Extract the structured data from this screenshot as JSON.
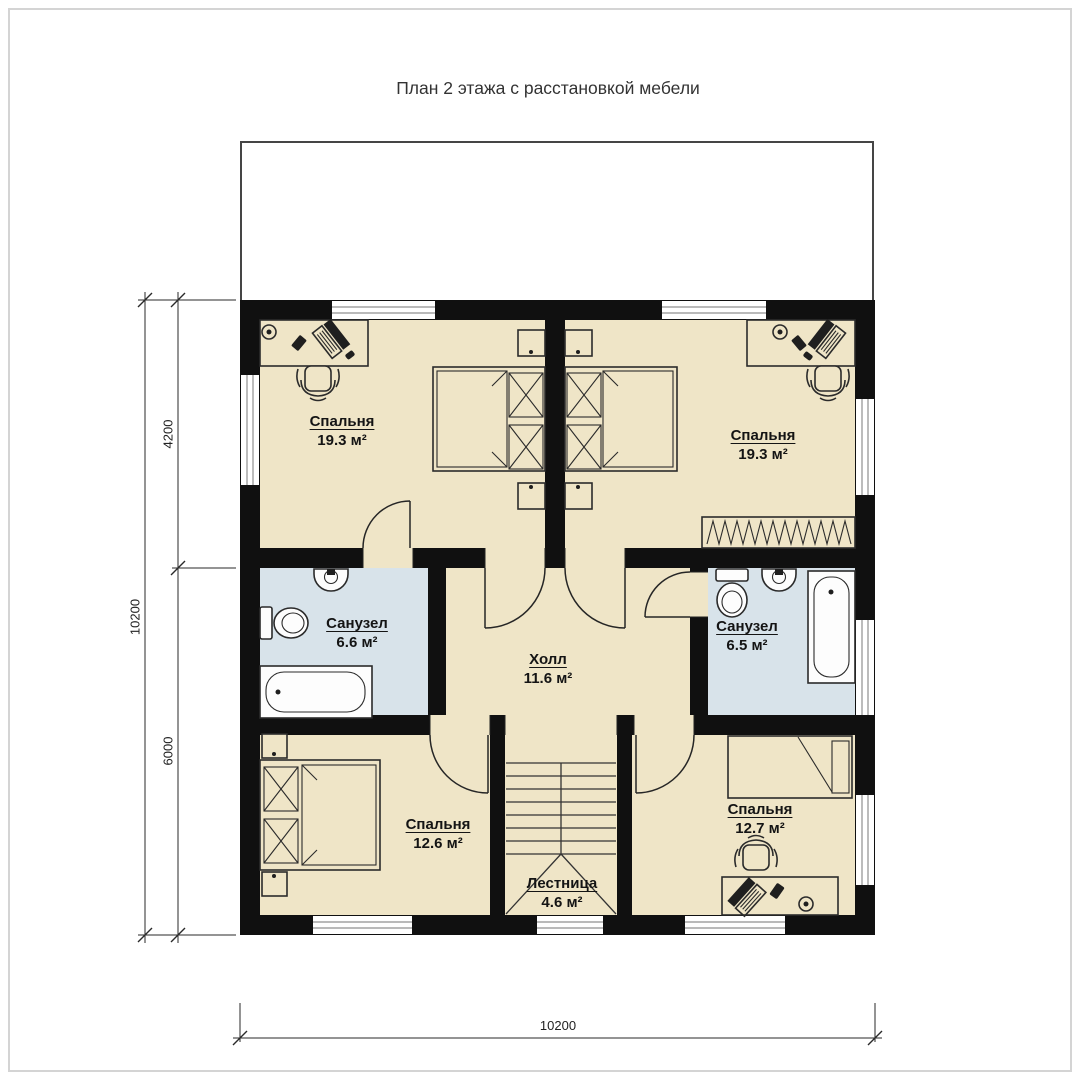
{
  "title": "План 2 этажа с расстановкой мебели",
  "rooms": [
    {
      "name": "Спальня",
      "area": "19.3 м²"
    },
    {
      "name": "Спальня",
      "area": "19.3 м²"
    },
    {
      "name": "Санузел",
      "area": "6.6 м²"
    },
    {
      "name": "Холл",
      "area": "11.6 м²"
    },
    {
      "name": "Санузел",
      "area": "6.5 м²"
    },
    {
      "name": "Спальня",
      "area": "12.6 м²"
    },
    {
      "name": "Спальня",
      "area": "12.7 м²"
    },
    {
      "name": "Лестница",
      "area": "4.6 м²"
    }
  ],
  "dimensions": {
    "left_total": "10200",
    "left_upper": "4200",
    "left_lower": "6000",
    "bottom_total": "10200"
  },
  "colors": {
    "wall": "#101010",
    "floor": "#efe5c7",
    "bathroom_floor": "#d8e3ea",
    "background": "#ffffff"
  }
}
